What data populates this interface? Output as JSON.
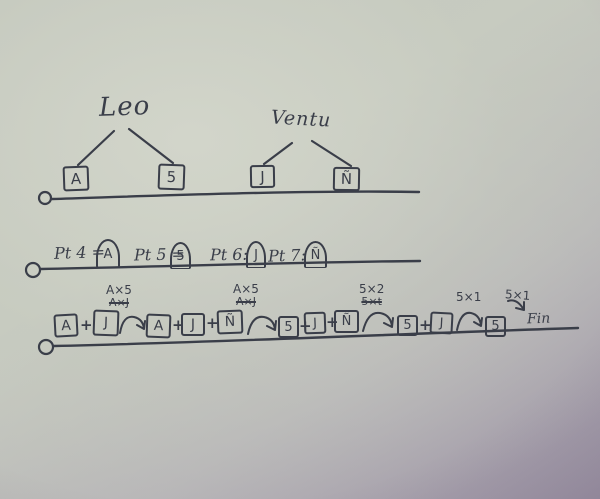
{
  "colors": {
    "ink": "#3a3e49",
    "paper_light": "#cdd1c6",
    "paper_shadow_purple": "#998fa2"
  },
  "tree": {
    "left_parent": "Leo",
    "right_parent": "Ventu",
    "left_children": [
      "A",
      "5"
    ],
    "right_children": [
      "J",
      "Ñ"
    ]
  },
  "points": {
    "items": [
      {
        "label": "Pt 4 =",
        "value": "A"
      },
      {
        "label": "Pt 5 =",
        "value": "5"
      },
      {
        "label": "Pt 6:",
        "value": "J"
      },
      {
        "label": "Pt 7:",
        "value": "Ñ"
      }
    ]
  },
  "sequence": {
    "plus": "+",
    "terms": [
      "A",
      "J",
      "A",
      "J",
      "Ñ",
      "5",
      "J",
      "Ñ",
      "5",
      "J",
      "5"
    ],
    "annotations": [
      {
        "kept": "A×5",
        "crossed": "A×J"
      },
      {
        "kept": "A×5",
        "crossed": "A×J"
      },
      {
        "kept": "5×2",
        "crossed": "5×t"
      },
      {
        "kept": "5×1",
        "crossed": ""
      },
      {
        "kept": "5×1",
        "crossed": ""
      }
    ],
    "end_label": "Fin"
  }
}
